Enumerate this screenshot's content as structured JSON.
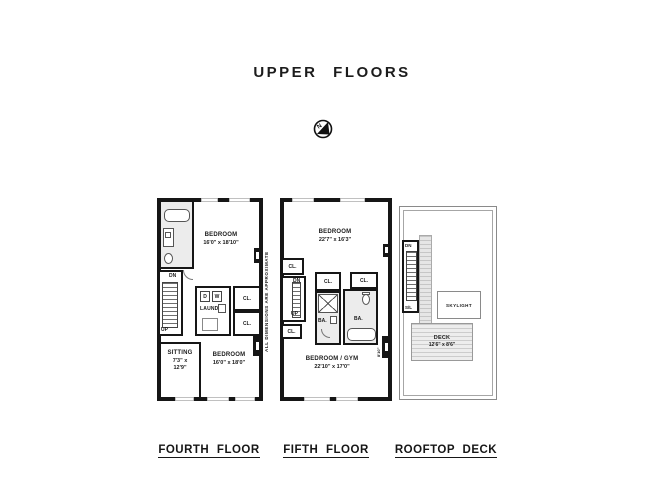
{
  "title": "UPPER FLOORS",
  "compass": {
    "letter": "N"
  },
  "note": "ALL DIMENSIONS ARE APPROXIMATE",
  "fourth": {
    "label": "FOURTH FLOOR",
    "bedroom_top": {
      "name": "BEDROOM",
      "dims": "16'0\" x 18'10\""
    },
    "bedroom_bottom": {
      "name": "BEDROOM",
      "dims": "16'0\" x 18'0\""
    },
    "sitting": {
      "name": "SITTING",
      "dims_line1": "7'3\" x",
      "dims_line2": "12'9\""
    },
    "laundry_label": "LAUND.",
    "dryer": "D",
    "washer": "W",
    "closet_top": "CL.",
    "closet_bottom": "CL.",
    "stair_dn": "DN",
    "stair_up": "UP"
  },
  "fifth": {
    "label": "FIFTH FLOOR",
    "bedroom_top": {
      "name": "BEDROOM",
      "dims": "22'7\" x 16'3\""
    },
    "bedroom_gym": {
      "name": "BEDROOM / GYM",
      "dims": "22'10\" x 17'0\""
    },
    "closet_left_top": "CL.",
    "closet_left_bottom": "CL.",
    "closet_mid": "CL.",
    "closet_right": "CL.",
    "bath_left": "BA.",
    "bath_right": "BA.",
    "stair_dn": "DN",
    "stair_up": "UP",
    "bay_dim": "8'10\""
  },
  "roof": {
    "label": "ROOFTOP DECK",
    "skylight": "SKYLIGHT",
    "deck": {
      "name": "DECK",
      "dims": "12'6\" x 8'6\""
    },
    "stair_dn": "DN",
    "stair_sl": "S/L"
  }
}
